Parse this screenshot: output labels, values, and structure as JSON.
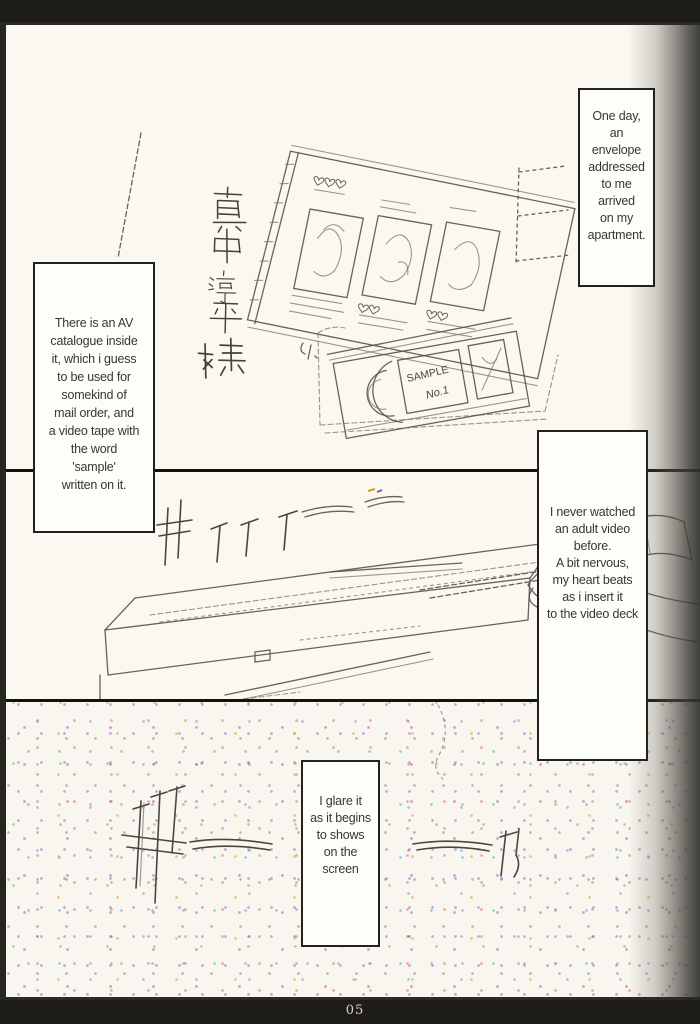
{
  "page": {
    "number": "05"
  },
  "captions": [
    {
      "id": "caption-top-right",
      "text": "One day,\nan\nenvelope\naddressed\nto me\narrived\non my\napartment."
    },
    {
      "id": "caption-left",
      "text": "There is an AV\ncatalogue inside\nit, which i guess\nto be used for\nsomekind of\nmail order, and\na video tape with\nthe word\n'sample'\nwritten on it."
    },
    {
      "id": "caption-right",
      "text": "I never watched\nan adult video\nbefore.\nA bit nervous,\nmy heart beats\nas i insert it\nto the video deck"
    },
    {
      "id": "caption-bottom",
      "text": "I glare it\nas it begins\nto shows\non the\nscreen"
    }
  ],
  "artwork": {
    "vhs_label_line1": "SAMPLE",
    "vhs_label_line2": "No.1",
    "envelope_address": "真中淳平様",
    "panel1_alt": "sketch of AV catalogue spread and sample video tape",
    "panel2_alt": "sketch of hand inserting video tape into video deck",
    "panel3_alt": "television static noise on screen"
  },
  "colors": {
    "page_background": "#faf8f1",
    "scanner_bar": "#1d1c18",
    "pencil_ink": "#5b564d",
    "caption_ink": "#3a362f"
  }
}
